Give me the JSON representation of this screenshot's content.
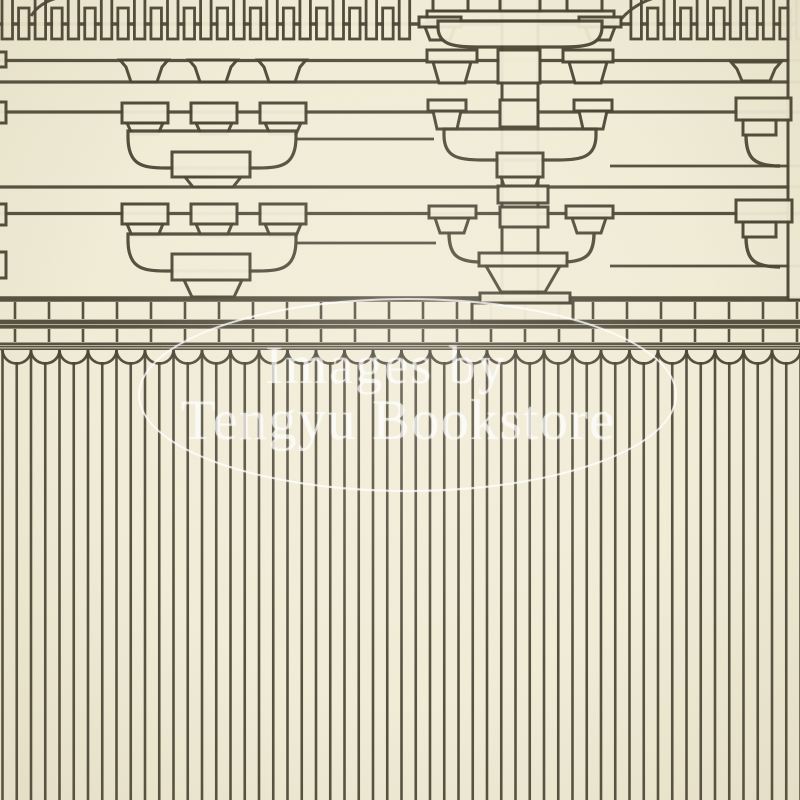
{
  "document": {
    "kind": "scanned-print-plate",
    "subject": "Close-up of a woodblock-printed elevation drawing of a traditional East Asian timber hall",
    "regions": {
      "top": "eave rafter-end comb over tiered bracket-arm (tokyo) clusters on horizontal tie beams",
      "middle": "wall-plate band with small batten frieze and a scalloped cap row",
      "bottom": "vertical batten lattice screen"
    }
  },
  "watermark": {
    "line1": "Images by",
    "line2": "Tengyu Bookstore",
    "text_color": "#ffffff",
    "text_opacity": 0.6,
    "ellipse_opacity": 0.78
  },
  "palette": {
    "paper": "#f3eed8",
    "paper_deep": "#ece5c9",
    "ink": "#4a4434"
  }
}
